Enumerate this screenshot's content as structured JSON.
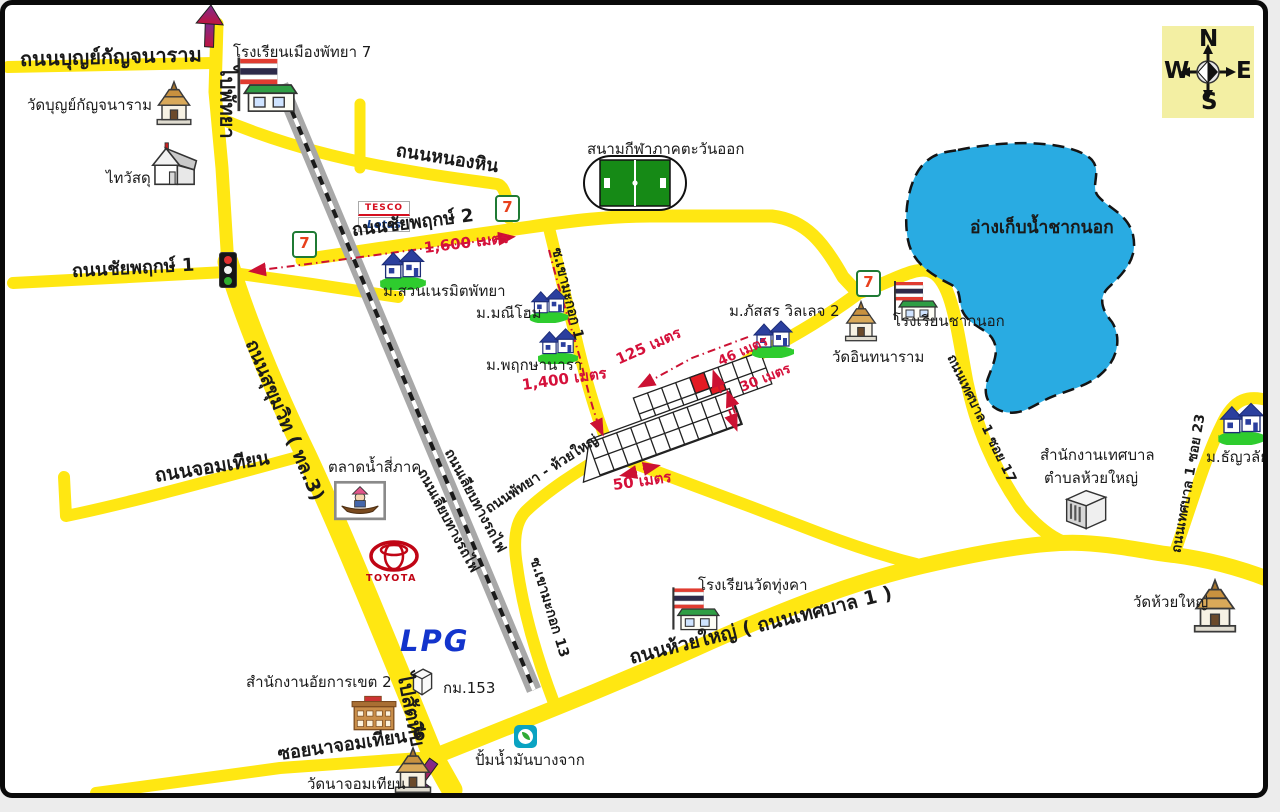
{
  "compass": {
    "north": "N",
    "east": "E",
    "south": "S",
    "west": "W"
  },
  "roads": {
    "boonkanjanaram": "ถนนบุญย์กัญจนาราม",
    "to_pattaya": "ไปพัทยา",
    "nong_hin": "ถนนหนองหิน",
    "chaiyapruek2": "ถนนชัยพฤกษ์ 2",
    "chaiyapruek1": "ถนนชัยพฤกษ์ 1",
    "sukhumvit": "ถนนสุขุมวิท ( ทล.3)",
    "jomtien": "ถนนจอมเทียน",
    "liab_railway": "ถนนเลียบทางรถไฟ",
    "khao_makok1": "ซ.เขามะกอก 1",
    "khao_makok13": "ซ.เขามะกอก 13",
    "pattaya_huaiyai": "ถนนพัทยา - ห้วยใหญ่",
    "huaiyai": "ถนนห้วยใหญ่ ( ถนนเทศบาล 1 )",
    "tessaban1_soi17": "ถนนเทศบาล 1 ซอย 17",
    "tessaban1_soi23": "ถนนเทศบาล 1 ซอย 23",
    "soi_najomtien6": "ซอยนาจอมเทียน 6",
    "to_sattahip": "ไปสัตหีบ"
  },
  "places": {
    "wat_boonkanjanaram": "วัดบุญย์กัญจนาราม",
    "thai_watsadu": "ไทวัสดุ",
    "school_pattaya7": "โรงเรียนเมืองพัทยา 7",
    "stadium": "สนามกีฬาภาคตะวันออก",
    "reservoir": "อ่างเก็บน้ำชากนอก",
    "m_suan_neramit": "ม.สวนเนรมิตพัทยา",
    "m_manee_home": "ม.มณีโฮม",
    "m_pruksa_nara": "ม.พฤกษานารา",
    "m_passorn": "ม.ภัสสร วิลเลจ 2",
    "wat_inthanaram": "วัดอินทนาราม",
    "school_chaknok": "โรงเรียนชากนอก",
    "tessaban_office_line1": "สำนักงานเทศบาล",
    "tessaban_office_line2": "ตำบลห้วยใหญ่",
    "m_thanwalai": "ม.ธัญวลัย",
    "wat_huaiyai": "วัดห้วยใหญ่",
    "school_wat_thungka": "โรงเรียนวัดทุ่งคา",
    "talad_nam": "ตลาดน้ำสี่ภาค",
    "attorney_office": "สำนักงานอัยการเขต 2",
    "km153": "กม.153",
    "wat_najomtien": "วัดนาจอมเทียน",
    "bangchak": "ปั้มน้ำมันบางจาก"
  },
  "distances": {
    "d1600": "1,600 เมตร",
    "d1400": "1,400 เมตร",
    "d125": "125 เมตร",
    "d46": "46 เมตร",
    "d30": "30 เมตร",
    "d50": "50 เมตร"
  },
  "brands": {
    "seven": "7",
    "tesco": "TESCO",
    "lotus": "Lotus",
    "toyota": "TOYOTA",
    "lpg": "LPG"
  },
  "colors": {
    "road": "#FFE712",
    "water": "#29ABE2",
    "route": "#CC1133",
    "field_green": "#168a16",
    "compass_bg": "#F3EFA3"
  }
}
